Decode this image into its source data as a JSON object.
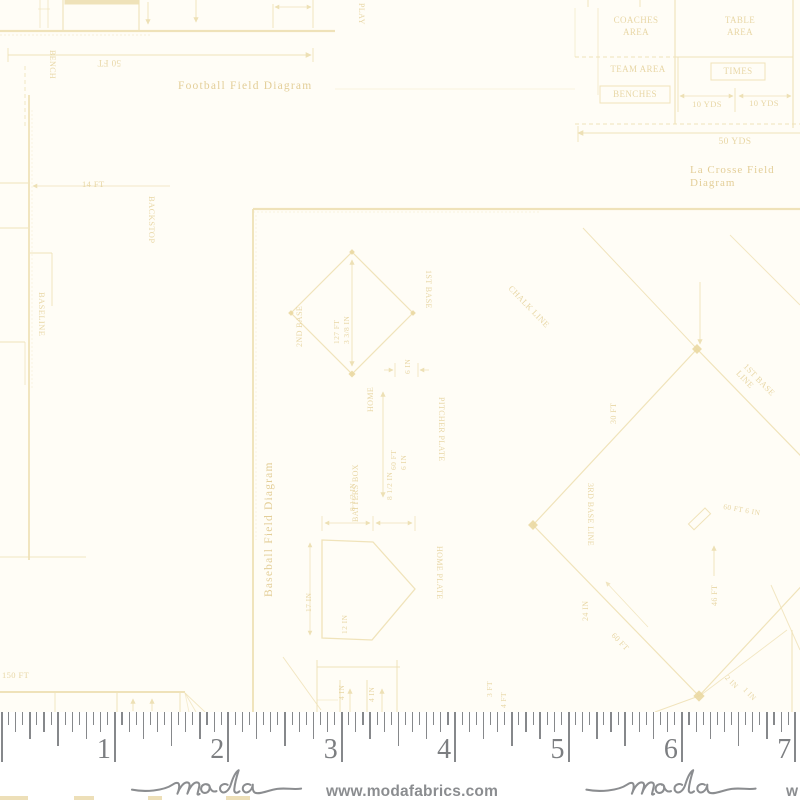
{
  "fabric": {
    "background": "#fffdf6",
    "ink": "#efe1b6",
    "text_ink": "#e7d5a2",
    "caption_ink": "#e2cc93",
    "dot_ink": "#ead8a2",
    "captions": {
      "football": "Football Field Diagram",
      "lacrosse": "La Crosse Field Diagram",
      "baseball": "Baseball Field Diagram"
    },
    "labels": [
      {
        "t": "Football Field Diagram",
        "x": 178,
        "y": 80,
        "r": 0,
        "s": 11.5,
        "cap": 1,
        "ls": 1.2
      },
      {
        "t": "50 FT",
        "x": 121,
        "y": 68,
        "r": 180,
        "s": 9
      },
      {
        "t": "BENCH",
        "x": 57,
        "y": 50,
        "r": 90,
        "s": 8
      },
      {
        "t": "PLAY",
        "x": 366,
        "y": 3,
        "r": 90,
        "s": 8
      },
      {
        "t": "14 FT",
        "x": 82,
        "y": 180,
        "r": 0,
        "s": 8.5
      },
      {
        "t": "BACKSTOP",
        "x": 156,
        "y": 196,
        "r": 90,
        "s": 8.5
      },
      {
        "t": "BASELINE",
        "x": 46,
        "y": 292,
        "r": 90,
        "s": 8.5
      },
      {
        "t": "COACHES\nAREA",
        "x": 596,
        "y": 14,
        "r": 0,
        "s": 9,
        "w": 80,
        "al": "center",
        "lh": 1.35
      },
      {
        "t": "TABLE\nAREA",
        "x": 698,
        "y": 14,
        "r": 0,
        "s": 9,
        "w": 84,
        "al": "center",
        "lh": 1.35
      },
      {
        "t": "TEAM AREA",
        "x": 600,
        "y": 64,
        "r": 0,
        "s": 9,
        "w": 76,
        "al": "center"
      },
      {
        "t": "TIMES",
        "x": 711,
        "y": 66,
        "r": 0,
        "s": 9,
        "w": 54,
        "al": "center"
      },
      {
        "t": "BENCHES",
        "x": 600,
        "y": 89,
        "r": 0,
        "s": 9,
        "w": 70,
        "al": "center"
      },
      {
        "t": "10 YDS",
        "x": 680,
        "y": 100,
        "r": 0,
        "s": 8.5,
        "w": 54,
        "al": "center"
      },
      {
        "t": "10 YDS",
        "x": 737,
        "y": 99,
        "r": 0,
        "s": 8.5,
        "w": 54,
        "al": "center"
      },
      {
        "t": "50 YDS",
        "x": 695,
        "y": 137,
        "r": 0,
        "s": 9.5,
        "w": 80,
        "al": "center"
      },
      {
        "t": "La Crosse Field Diagram",
        "x": 690,
        "y": 164,
        "r": 0,
        "s": 11,
        "cap": 1,
        "ls": 1
      },
      {
        "t": "Baseball Field Diagram",
        "x": 263,
        "y": 597,
        "r": -90,
        "s": 11.5,
        "cap": 1,
        "ls": 1.2
      },
      {
        "t": "2ND BASE",
        "x": 295,
        "y": 347,
        "r": -90,
        "s": 8
      },
      {
        "t": "1ST BASE",
        "x": 433,
        "y": 270,
        "r": 90,
        "s": 8
      },
      {
        "t": "HOME",
        "x": 366,
        "y": 412,
        "r": -90,
        "s": 8
      },
      {
        "t": "127 FT\n3 3/8 IN",
        "x": 332,
        "y": 344,
        "r": -90,
        "s": 7.5,
        "lh": 1.3
      },
      {
        "t": "6 IN",
        "x": 404,
        "y": 374,
        "r": -90,
        "s": 7.5
      },
      {
        "t": "60 FT\n6 IN",
        "x": 389,
        "y": 470,
        "r": -90,
        "s": 7.5,
        "lh": 1.3
      },
      {
        "t": "PITCHER PLATE",
        "x": 446,
        "y": 397,
        "r": 90,
        "s": 8
      },
      {
        "t": "BATTERS BOX",
        "x": 351,
        "y": 522,
        "r": -90,
        "s": 8
      },
      {
        "t": "8 1/2 IN",
        "x": 349,
        "y": 511,
        "r": -90,
        "s": 7.5
      },
      {
        "t": "8 1/2 IN",
        "x": 386,
        "y": 500,
        "r": -90,
        "s": 7.5
      },
      {
        "t": "17 IN",
        "x": 305,
        "y": 612,
        "r": -90,
        "s": 7.5
      },
      {
        "t": "12 IN",
        "x": 341,
        "y": 634,
        "r": -90,
        "s": 7.5
      },
      {
        "t": "HOME PLATE",
        "x": 444,
        "y": 546,
        "r": 90,
        "s": 8
      },
      {
        "t": "4 IN",
        "x": 338,
        "y": 700,
        "r": -90,
        "s": 7.5
      },
      {
        "t": "4 IN",
        "x": 368,
        "y": 702,
        "r": -90,
        "s": 7.5
      },
      {
        "t": "150 FT",
        "x": 2,
        "y": 671,
        "r": 0,
        "s": 8.5
      },
      {
        "t": "CHALK LINE",
        "x": 513,
        "y": 284,
        "r": 46,
        "s": 8.5
      },
      {
        "t": "1ST BASE LINE",
        "x": 748,
        "y": 362,
        "r": 46,
        "s": 8.5
      },
      {
        "t": "3RD BASE LINE",
        "x": 595,
        "y": 483,
        "r": 90,
        "s": 8
      },
      {
        "t": "30 FT",
        "x": 609,
        "y": 424,
        "r": -90,
        "s": 8
      },
      {
        "t": "24 IN",
        "x": 581,
        "y": 621,
        "r": -90,
        "s": 8
      },
      {
        "t": "60 FT",
        "x": 616,
        "y": 631,
        "r": 46,
        "s": 8
      },
      {
        "t": "46 FT",
        "x": 710,
        "y": 606,
        "r": -90,
        "s": 8
      },
      {
        "t": "60 FT 6 IN",
        "x": 724,
        "y": 503,
        "r": 10,
        "s": 7.5
      },
      {
        "t": "2 IN",
        "x": 729,
        "y": 674,
        "r": 46,
        "s": 7.5
      },
      {
        "t": "1 IN",
        "x": 747,
        "y": 686,
        "r": 46,
        "s": 7.5
      },
      {
        "t": "3 FT",
        "x": 486,
        "y": 697,
        "r": -90,
        "s": 7.5
      },
      {
        "t": "4 FT",
        "x": 500,
        "y": 708,
        "r": -90,
        "s": 7.5
      }
    ],
    "lines": [
      {
        "x1": 0,
        "y1": 31,
        "x2": 335,
        "y2": 31,
        "w": 2.2
      },
      {
        "x1": 0,
        "y1": 35,
        "x2": 150,
        "y2": 35,
        "w": 1,
        "op": 0.45,
        "dash": "2 2"
      },
      {
        "x1": 40,
        "y1": 0,
        "x2": 40,
        "y2": 28,
        "w": 1,
        "op": 0.7
      },
      {
        "x1": 48,
        "y1": 0,
        "x2": 48,
        "y2": 28,
        "w": 1,
        "op": 0.7
      },
      {
        "x1": 38,
        "y1": 9,
        "x2": 50,
        "y2": 9,
        "w": 0.8,
        "op": 0.7
      },
      {
        "x1": 63,
        "y1": 0,
        "x2": 63,
        "y2": 31,
        "w": 1.1
      },
      {
        "x1": 139,
        "y1": 0,
        "x2": 139,
        "y2": 31,
        "w": 1.1
      },
      {
        "x1": 148,
        "y1": 2,
        "x2": 148,
        "y2": 24,
        "w": 0.9,
        "arrow": "end"
      },
      {
        "x1": 196,
        "y1": 0,
        "x2": 196,
        "y2": 22,
        "w": 0.9,
        "arrow": "end"
      },
      {
        "x1": 273,
        "y1": 4,
        "x2": 273,
        "y2": 28,
        "w": 0.9
      },
      {
        "x1": 313,
        "y1": 0,
        "x2": 313,
        "y2": 28,
        "w": 0.9
      },
      {
        "x1": 275,
        "y1": 7,
        "x2": 311,
        "y2": 7,
        "w": 0.8,
        "arrow": "both"
      },
      {
        "x1": 8,
        "y1": 55,
        "x2": 311,
        "y2": 55,
        "w": 1,
        "arrow": "end"
      },
      {
        "x1": 8,
        "y1": 48,
        "x2": 8,
        "y2": 62,
        "w": 0.9
      },
      {
        "x1": 313,
        "y1": 48,
        "x2": 313,
        "y2": 62,
        "w": 0.9
      },
      {
        "x1": 25,
        "y1": 66,
        "x2": 25,
        "y2": 128,
        "w": 1,
        "dash": "4 3",
        "op": 0.8
      },
      {
        "x1": 335,
        "y1": 89,
        "x2": 575,
        "y2": 89,
        "w": 0.8,
        "op": 0.5
      },
      {
        "x1": 29,
        "y1": 95,
        "x2": 29,
        "y2": 560,
        "w": 1.8
      },
      {
        "x1": 32,
        "y1": 110,
        "x2": 32,
        "y2": 390,
        "w": 1,
        "op": 0.3,
        "dash": "2 2"
      },
      {
        "x1": 0,
        "y1": 183,
        "x2": 28,
        "y2": 183,
        "w": 1.1
      },
      {
        "x1": 0,
        "y1": 228,
        "x2": 28,
        "y2": 228,
        "w": 1.1
      },
      {
        "x1": 33,
        "y1": 186,
        "x2": 170,
        "y2": 186,
        "w": 0.8,
        "arrow": "start"
      },
      {
        "x1": 30,
        "y1": 253,
        "x2": 52,
        "y2": 253,
        "w": 0.9
      },
      {
        "x1": 52,
        "y1": 253,
        "x2": 52,
        "y2": 306,
        "w": 0.9
      },
      {
        "x1": 0,
        "y1": 342,
        "x2": 25,
        "y2": 342,
        "w": 1.1
      },
      {
        "x1": 25,
        "y1": 342,
        "x2": 25,
        "y2": 385,
        "w": 0.9,
        "op": 0.8
      },
      {
        "x1": 0,
        "y1": 557,
        "x2": 86,
        "y2": 557,
        "w": 1.1,
        "op": 0.8
      },
      {
        "x1": 575,
        "y1": 8,
        "x2": 575,
        "y2": 57,
        "w": 0.9,
        "op": 0.6
      },
      {
        "x1": 598,
        "y1": 8,
        "x2": 598,
        "y2": 95,
        "w": 0.9,
        "op": 0.7
      },
      {
        "x1": 675,
        "y1": 0,
        "x2": 675,
        "y2": 124,
        "w": 1.1
      },
      {
        "x1": 793,
        "y1": 0,
        "x2": 793,
        "y2": 128,
        "w": 1.1
      },
      {
        "x1": 575,
        "y1": 57,
        "x2": 675,
        "y2": 57,
        "w": 1,
        "dash": "4 3"
      },
      {
        "x1": 675,
        "y1": 57,
        "x2": 793,
        "y2": 57,
        "w": 1
      },
      {
        "x1": 678,
        "y1": 57,
        "x2": 678,
        "y2": 112,
        "w": 0.9
      },
      {
        "x1": 735,
        "y1": 88,
        "x2": 735,
        "y2": 112,
        "w": 0.9
      },
      {
        "x1": 680,
        "y1": 96,
        "x2": 733,
        "y2": 96,
        "w": 0.8,
        "arrow": "both"
      },
      {
        "x1": 739,
        "y1": 96,
        "x2": 791,
        "y2": 96,
        "w": 0.8,
        "arrow": "both"
      },
      {
        "x1": 575,
        "y1": 124,
        "x2": 800,
        "y2": 124,
        "w": 1,
        "dash": "4 3"
      },
      {
        "x1": 578,
        "y1": 133,
        "x2": 800,
        "y2": 133,
        "w": 1,
        "arrow": "start"
      },
      {
        "x1": 578,
        "y1": 126,
        "x2": 578,
        "y2": 142,
        "w": 0.9
      },
      {
        "x1": 588,
        "y1": 0,
        "x2": 588,
        "y2": 7,
        "w": 0.9
      },
      {
        "x1": 640,
        "y1": 0,
        "x2": 640,
        "y2": 7,
        "w": 0.9
      },
      {
        "x1": 253,
        "y1": 209,
        "x2": 800,
        "y2": 209,
        "w": 2.2
      },
      {
        "x1": 253,
        "y1": 212,
        "x2": 540,
        "y2": 212,
        "w": 1,
        "op": 0.35,
        "dash": "2 2"
      },
      {
        "x1": 253,
        "y1": 209,
        "x2": 253,
        "y2": 712,
        "w": 1.9
      },
      {
        "x1": 256,
        "y1": 215,
        "x2": 256,
        "y2": 540,
        "w": 1,
        "op": 0.3,
        "dash": "2 2"
      },
      {
        "x1": 352,
        "y1": 260,
        "x2": 352,
        "y2": 366,
        "w": 0.9,
        "arrow": "both"
      },
      {
        "x1": 395,
        "y1": 363,
        "x2": 395,
        "y2": 377,
        "w": 0.8
      },
      {
        "x1": 418,
        "y1": 363,
        "x2": 418,
        "y2": 377,
        "w": 0.8
      },
      {
        "x1": 384,
        "y1": 370,
        "x2": 393,
        "y2": 370,
        "w": 0.8,
        "arrow": "end"
      },
      {
        "x1": 429,
        "y1": 370,
        "x2": 420,
        "y2": 370,
        "w": 0.8,
        "arrow": "end"
      },
      {
        "x1": 383,
        "y1": 392,
        "x2": 383,
        "y2": 497,
        "w": 0.9,
        "arrow": "both"
      },
      {
        "x1": 322,
        "y1": 516,
        "x2": 322,
        "y2": 531,
        "w": 0.8
      },
      {
        "x1": 373,
        "y1": 516,
        "x2": 373,
        "y2": 531,
        "w": 0.8
      },
      {
        "x1": 415,
        "y1": 516,
        "x2": 415,
        "y2": 531,
        "w": 0.8
      },
      {
        "x1": 325,
        "y1": 523,
        "x2": 370,
        "y2": 523,
        "w": 0.8,
        "arrow": "both"
      },
      {
        "x1": 376,
        "y1": 523,
        "x2": 412,
        "y2": 523,
        "w": 0.8,
        "arrow": "both"
      },
      {
        "x1": 310,
        "y1": 543,
        "x2": 310,
        "y2": 635,
        "w": 0.8,
        "arrow": "both"
      },
      {
        "x1": 317,
        "y1": 660,
        "x2": 317,
        "y2": 712,
        "w": 1
      },
      {
        "x1": 340,
        "y1": 680,
        "x2": 340,
        "y2": 712,
        "w": 1
      },
      {
        "x1": 367,
        "y1": 680,
        "x2": 367,
        "y2": 712,
        "w": 1
      },
      {
        "x1": 397,
        "y1": 660,
        "x2": 397,
        "y2": 712,
        "w": 1
      },
      {
        "x1": 317,
        "y1": 667,
        "x2": 400,
        "y2": 667,
        "w": 1
      },
      {
        "x1": 317,
        "y1": 700,
        "x2": 338,
        "y2": 700,
        "w": 0.8,
        "op": 0.7
      },
      {
        "x1": 350,
        "y1": 712,
        "x2": 350,
        "y2": 689,
        "w": 0.9,
        "arrow": "end"
      },
      {
        "x1": 382,
        "y1": 712,
        "x2": 382,
        "y2": 689,
        "w": 0.9,
        "arrow": "end"
      },
      {
        "x1": 0,
        "y1": 692,
        "x2": 185,
        "y2": 692,
        "w": 2
      },
      {
        "x1": 55,
        "y1": 693,
        "x2": 55,
        "y2": 712,
        "w": 1,
        "op": 0.8
      },
      {
        "x1": 117,
        "y1": 693,
        "x2": 117,
        "y2": 712,
        "w": 1
      },
      {
        "x1": 180,
        "y1": 693,
        "x2": 180,
        "y2": 712,
        "w": 1
      },
      {
        "x1": 133,
        "y1": 711,
        "x2": 133,
        "y2": 699,
        "w": 0.9,
        "arrow": "end"
      },
      {
        "x1": 152,
        "y1": 711,
        "x2": 152,
        "y2": 699,
        "w": 0.9,
        "arrow": "end"
      },
      {
        "x1": 185,
        "y1": 693,
        "x2": 205,
        "y2": 712,
        "w": 0.9,
        "op": 0.8
      },
      {
        "x1": 185,
        "y1": 693,
        "x2": 196,
        "y2": 712,
        "w": 0.9,
        "op": 0.7
      },
      {
        "x1": 185,
        "y1": 693,
        "x2": 189,
        "y2": 712,
        "w": 0.9,
        "op": 0.6
      },
      {
        "x1": 283,
        "y1": 657,
        "x2": 321,
        "y2": 710,
        "w": 1,
        "op": 0.8
      },
      {
        "x1": 583,
        "y1": 228,
        "x2": 697,
        "y2": 349,
        "w": 1,
        "op": 0.9
      },
      {
        "x1": 730,
        "y1": 235,
        "x2": 800,
        "y2": 305,
        "w": 1,
        "op": 0.8
      },
      {
        "x1": 700,
        "y1": 282,
        "x2": 700,
        "y2": 344,
        "w": 0.9,
        "arrow": "end"
      },
      {
        "x1": 714,
        "y1": 576,
        "x2": 714,
        "y2": 546,
        "w": 0.9,
        "arrow": "end"
      },
      {
        "x1": 648,
        "y1": 627,
        "x2": 606,
        "y2": 582,
        "w": 0.8,
        "op": 0.8,
        "arrow": "end"
      },
      {
        "x1": 771,
        "y1": 585,
        "x2": 800,
        "y2": 650,
        "w": 1,
        "op": 0.8
      },
      {
        "x1": 792,
        "y1": 630,
        "x2": 792,
        "y2": 712,
        "w": 1.1,
        "op": 0.9
      },
      {
        "x1": 787,
        "y1": 630,
        "x2": 701,
        "y2": 695,
        "w": 0.9,
        "op": 0.8
      },
      {
        "x1": 699,
        "y1": 696,
        "x2": 655,
        "y2": 712,
        "w": 1,
        "op": 0.9
      }
    ],
    "polys": [
      {
        "pts": "352,252 413,313 352,374 291,313",
        "w": 1.2
      },
      {
        "pts": "322,540 373,542 415,589 372,640 322,638",
        "w": 1.3
      },
      {
        "pts": "697,349 863,520 699,696 533,525",
        "w": 1.2
      }
    ],
    "rects": [
      {
        "x": 65,
        "y": 0,
        "w": 74,
        "h": 4,
        "fill": 1
      },
      {
        "x": 711,
        "y": 63,
        "w": 54,
        "h": 17
      },
      {
        "x": 600,
        "y": 86,
        "w": 70,
        "h": 17
      },
      {
        "x": 705,
        "y": 508,
        "w": 8,
        "h": 23,
        "rot": 46
      }
    ],
    "dots": [
      {
        "x": 352,
        "y": 252,
        "s": 4
      },
      {
        "x": 291,
        "y": 313,
        "s": 4
      },
      {
        "x": 413,
        "y": 313,
        "s": 4
      },
      {
        "x": 352,
        "y": 374,
        "s": 5
      },
      {
        "x": 697,
        "y": 349,
        "s": 7
      },
      {
        "x": 533,
        "y": 525,
        "s": 7
      },
      {
        "x": 699,
        "y": 696,
        "s": 8
      }
    ],
    "edge_marks": [
      {
        "x": 0,
        "w": 28
      },
      {
        "x": 74,
        "w": 20
      },
      {
        "x": 148,
        "w": 14
      },
      {
        "x": 226,
        "w": 24
      }
    ]
  },
  "ruler": {
    "numbers": [
      "1",
      "2",
      "3",
      "4",
      "5",
      "6",
      "7"
    ],
    "pixels_per_inch": 113.4,
    "origin_x": 1.5,
    "divisions_per_inch": 16,
    "tick_heights": {
      "inch": 50,
      "half": 34,
      "quarter": 26.5,
      "eighth": 19.5,
      "sixteenth": 13
    },
    "tick_color": "#86888b",
    "number_color": "#7c7e81"
  },
  "footer": {
    "brand": "moda",
    "url": "www.modafabrics.com",
    "url_partial": "w",
    "ink": "#8b8d90"
  }
}
